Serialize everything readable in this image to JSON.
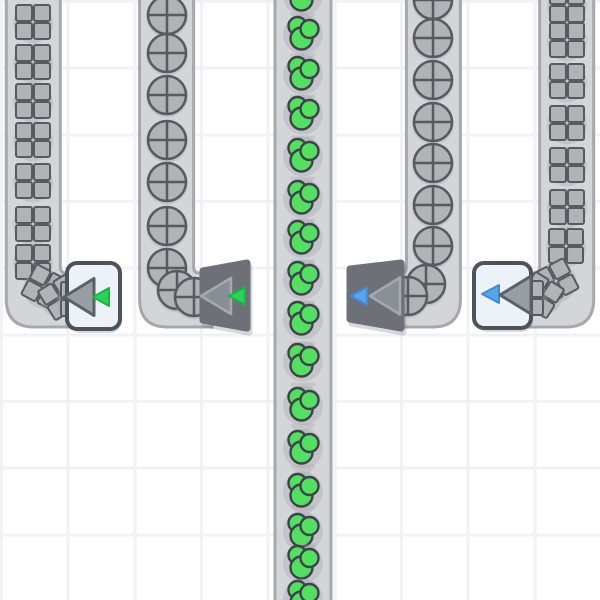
{
  "scene": {
    "grid": {
      "cell_size": 66.67,
      "cell_color": "#ffffff",
      "line_color": "#f1f2f5"
    },
    "palette": {
      "belt_surface": "#d3d5d9",
      "belt_edge": "#a5a8ad",
      "belt_chevron": "#c4c6ca",
      "item_gray": "#b1b3b7",
      "item_outline": "#565b61",
      "cluster_green": "#54de62",
      "cluster_outline": "#3d4349",
      "arrow_green": "#2cd15a",
      "arrow_green_stroke": "#23af4a",
      "arrow_blue": "#57a3ec",
      "arrow_blue_stroke": "#4689d2",
      "building_light": "#edf1f8",
      "building_light_border": "#4e5359",
      "building_dark": "#6d7177",
      "triangle_gray_light": "#999ea5",
      "triangle_gray_light_stroke": "#5c6167",
      "triangle_gray_dark": "#8a8f96",
      "triangle_gray_dark_stroke": "#a4a9af",
      "shadow": "rgba(100,104,112,0.25)"
    },
    "belts": [
      {
        "id": "conveyor-belt-1",
        "item_type": "square",
        "path": "M6.3,-10 L6.3,299 Q6.3,327 34,327 L80,327 L80,273 L66.3,273 Q60.3,273 60.3,267 L60.3,-10 Z",
        "chevron_x": 33,
        "chevron_ys": [],
        "items": [
          [
            33,
            22
          ],
          [
            33,
            62
          ],
          [
            33,
            101
          ],
          [
            33,
            140
          ],
          [
            33,
            181
          ],
          [
            33,
            224
          ],
          [
            33,
            262
          ],
          [
            44,
            287,
            28
          ],
          [
            61,
            297,
            58
          ],
          [
            78,
            299,
            90
          ]
        ]
      },
      {
        "id": "conveyor-belt-2",
        "item_type": "circle",
        "path": "M139.6,-10 L139.6,299 Q139.6,327 167.4,327 L212,327 L212,273 L199.6,273 Q193.6,273 193.6,267 L193.6,-10 Z",
        "chevron_x": 167,
        "chevron_ys": [],
        "items": [
          [
            167,
            15
          ],
          [
            167,
            53
          ],
          [
            167,
            95
          ],
          [
            167,
            140
          ],
          [
            167,
            182
          ],
          [
            167,
            226
          ],
          [
            167,
            268
          ],
          [
            177,
            290
          ],
          [
            194,
            297
          ]
        ]
      },
      {
        "id": "conveyor-belt-3",
        "item_type": "cluster",
        "path": "M275,-10 L275,610 L331,610 L331,-10 Z",
        "chevron_x": 303,
        "chevron_ys": [
          14,
          55,
          96,
          137,
          178,
          220,
          261,
          302,
          343,
          384,
          425,
          466,
          507,
          545,
          583
        ],
        "items": [
          [
            303,
            -6
          ],
          [
            303,
            33
          ],
          [
            303,
            73
          ],
          [
            303,
            113
          ],
          [
            303,
            155
          ],
          [
            303,
            197
          ],
          [
            303,
            237
          ],
          [
            303,
            278
          ],
          [
            303,
            318
          ],
          [
            303,
            360
          ],
          [
            303,
            404
          ],
          [
            303,
            447
          ],
          [
            303,
            490
          ],
          [
            303,
            530
          ],
          [
            303,
            562
          ],
          [
            303,
            597
          ]
        ]
      },
      {
        "id": "conveyor-belt-4",
        "item_type": "circle",
        "path": "M460.4,-10 L460.4,299 Q460.4,327 432.6,327 L388,327 L388,273 L400.4,273 Q406.4,273 406.4,267 L406.4,-10 Z",
        "chevron_x": 433,
        "chevron_ys": [],
        "items": [
          [
            433,
            0
          ],
          [
            433,
            38
          ],
          [
            433,
            80
          ],
          [
            433,
            122
          ],
          [
            433,
            163
          ],
          [
            433,
            205
          ],
          [
            433,
            246
          ],
          [
            426,
            284
          ],
          [
            408,
            296
          ]
        ]
      },
      {
        "id": "conveyor-belt-5",
        "item_type": "square",
        "path": "M593.7,-10 L593.7,299 Q593.7,327 565.9,327 L520,327 L520,273 L533.7,273 Q539.7,273 539.7,267 L539.7,-10 Z",
        "chevron_x": 567,
        "chevron_ys": [],
        "items": [
          [
            567,
            5
          ],
          [
            567,
            40
          ],
          [
            567,
            81
          ],
          [
            567,
            123
          ],
          [
            567,
            165
          ],
          [
            567,
            207
          ],
          [
            566,
            246
          ],
          [
            556,
            281,
            -28
          ],
          [
            541,
            295,
            -58
          ],
          [
            526,
            298,
            -90
          ]
        ]
      }
    ],
    "buildings": [
      {
        "id": "collector-building-1",
        "kind": "box",
        "x": 67,
        "y": 263,
        "w": 53,
        "h": 66,
        "arrows": [
          {
            "name": "intake-arrow-icon",
            "tip": [
              64,
              297
            ],
            "w": 30,
            "h": 37,
            "fill": "gray-light",
            "stroke": "gray-light-stroke",
            "sw": 3
          },
          {
            "name": "green-indicator-arrow-icon",
            "tip": [
              93,
              297
            ],
            "w": 16,
            "h": 18,
            "fill": "green",
            "stroke": "green-stroke",
            "sw": 2
          }
        ]
      },
      {
        "id": "collector-building-2",
        "kind": "trapezoid",
        "points": [
          [
            203,
            271
          ],
          [
            247,
            263
          ],
          [
            247,
            328
          ],
          [
            203,
            320
          ]
        ],
        "arrows": [
          {
            "name": "intake-arrow-icon",
            "tip": [
              201,
              296
            ],
            "w": 30,
            "h": 36,
            "fill": "gray-dark",
            "stroke": "gray-dark-stroke",
            "sw": 2.5
          },
          {
            "name": "green-indicator-arrow-icon",
            "tip": [
              229,
              296
            ],
            "w": 16,
            "h": 18,
            "fill": "green",
            "stroke": "green-stroke",
            "sw": 2
          }
        ]
      },
      {
        "id": "collector-building-3",
        "kind": "trapezoid",
        "points": [
          [
            350,
            269
          ],
          [
            401,
            263
          ],
          [
            401,
            328
          ],
          [
            350,
            319
          ]
        ],
        "arrows": [
          {
            "name": "blue-indicator-arrow-icon",
            "tip": [
              351,
              296
            ],
            "w": 16,
            "h": 18,
            "fill": "blue",
            "stroke": "blue-stroke",
            "sw": 2
          },
          {
            "name": "intake-arrow-icon",
            "tip": [
              370,
              296
            ],
            "w": 30,
            "h": 37,
            "fill": "gray-dark",
            "stroke": "gray-dark-stroke",
            "sw": 2.5
          }
        ]
      },
      {
        "id": "collector-building-4",
        "kind": "box",
        "x": 474,
        "y": 263,
        "w": 57,
        "h": 65,
        "arrows": [
          {
            "name": "blue-indicator-arrow-icon",
            "tip": [
              482,
              294
            ],
            "w": 17,
            "h": 18,
            "fill": "blue",
            "stroke": "blue-stroke",
            "sw": 2
          },
          {
            "name": "intake-arrow-icon",
            "tip": [
              500,
              295
            ],
            "w": 31,
            "h": 38,
            "fill": "gray-light",
            "stroke": "gray-light-stroke",
            "sw": 3
          }
        ]
      }
    ]
  }
}
